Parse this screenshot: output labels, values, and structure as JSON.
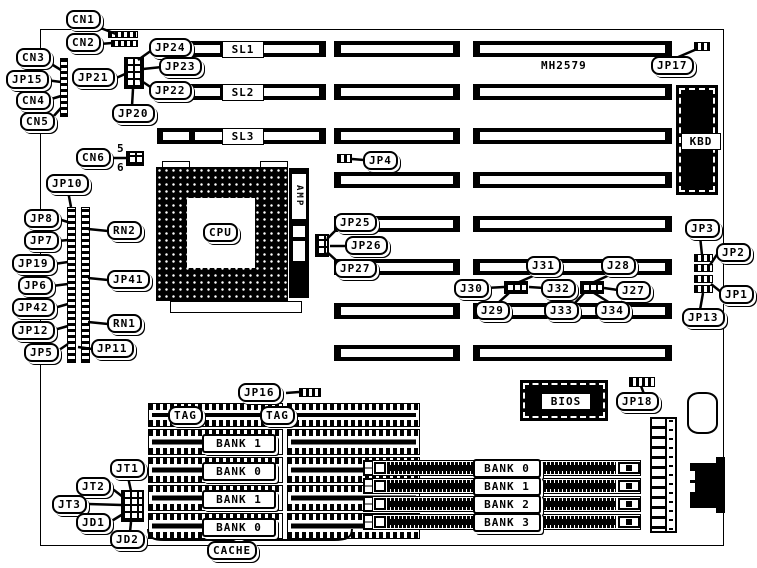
{
  "board": {
    "part_number": "MH2579"
  },
  "slots": {
    "sl1": "SL1",
    "sl2": "SL2",
    "sl3": "SL3"
  },
  "chips": {
    "cpu": "CPU",
    "amp": "AMP",
    "kbd": "KBD",
    "bios": "BIOS"
  },
  "cache": {
    "title": "CACHE",
    "tags": [
      "TAG",
      "TAG"
    ],
    "banks": [
      "BANK 1",
      "BANK 0",
      "BANK 1",
      "BANK 0"
    ]
  },
  "simm": {
    "banks": [
      "BANK 0",
      "BANK 1",
      "BANK 2",
      "BANK 3"
    ]
  },
  "cn6_pins": {
    "top": "5",
    "bottom": "6"
  },
  "callouts": {
    "cn1": "CN1",
    "cn2": "CN2",
    "cn3": "CN3",
    "cn4": "CN4",
    "cn5": "CN5",
    "cn6": "CN6",
    "jp15": "JP15",
    "jp21": "JP21",
    "jp24": "JP24",
    "jp23": "JP23",
    "jp22": "JP22",
    "jp20": "JP20",
    "jp10": "JP10",
    "jp8": "JP8",
    "jp7": "JP7",
    "jp19": "JP19",
    "jp6": "JP6",
    "jp42": "JP42",
    "jp12": "JP12",
    "jp5": "JP5",
    "rn2": "RN2",
    "jp41": "JP41",
    "rn1": "RN1",
    "jp11": "JP11",
    "jp4": "JP4",
    "jp25": "JP25",
    "jp26": "JP26",
    "jp27": "JP27",
    "jp17": "JP17",
    "jp3": "JP3",
    "jp2": "JP2",
    "jp1": "JP1",
    "jp13": "JP13",
    "j31": "J31",
    "j28": "J28",
    "j30": "J30",
    "j32": "J32",
    "j27": "J27",
    "j29": "J29",
    "j33": "J33",
    "j34": "J34",
    "jp16": "JP16",
    "jp18": "JP18",
    "jt1": "JT1",
    "jt2": "JT2",
    "jt3": "JT3",
    "jd1": "JD1",
    "jd2": "JD2"
  },
  "colors": {
    "ink": "#000000",
    "paper": "#ffffff"
  }
}
